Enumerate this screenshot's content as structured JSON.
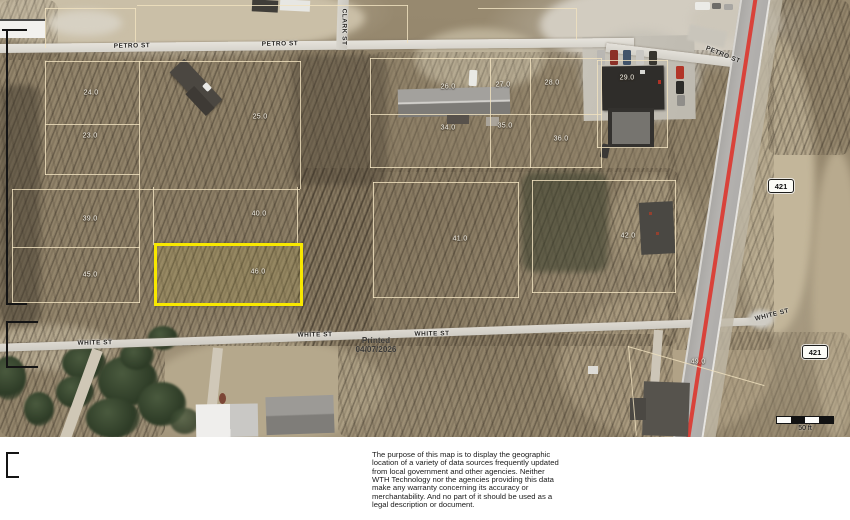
{
  "map": {
    "street_labels": [
      {
        "text": "PETRO ST",
        "x": 132,
        "y": 46,
        "rot": -1
      },
      {
        "text": "PETRO ST",
        "x": 280,
        "y": 44,
        "rot": -1
      },
      {
        "text": "PETRO ST",
        "x": 723,
        "y": 55,
        "rot": 22
      },
      {
        "text": "CLARK ST",
        "x": 344,
        "y": 27,
        "rot": 90
      },
      {
        "text": "WHITE ST",
        "x": 95,
        "y": 343,
        "rot": -1
      },
      {
        "text": "WHITE ST",
        "x": 315,
        "y": 335,
        "rot": -1
      },
      {
        "text": "WHITE ST",
        "x": 432,
        "y": 334,
        "rot": -1
      },
      {
        "text": "WHITE ST",
        "x": 772,
        "y": 315,
        "rot": -14
      }
    ],
    "parcel_labels": [
      {
        "text": "24.0",
        "x": 91,
        "y": 93
      },
      {
        "text": "23.0",
        "x": 90,
        "y": 136
      },
      {
        "text": "25.0",
        "x": 260,
        "y": 117
      },
      {
        "text": "26.0",
        "x": 448,
        "y": 87
      },
      {
        "text": "27.0",
        "x": 503,
        "y": 85
      },
      {
        "text": "28.0",
        "x": 552,
        "y": 83
      },
      {
        "text": "29.0",
        "x": 627,
        "y": 78
      },
      {
        "text": "34.0",
        "x": 448,
        "y": 128
      },
      {
        "text": "35.0",
        "x": 505,
        "y": 126
      },
      {
        "text": "36.0",
        "x": 561,
        "y": 139
      },
      {
        "text": "39.0",
        "x": 90,
        "y": 219
      },
      {
        "text": "40.0",
        "x": 259,
        "y": 214
      },
      {
        "text": "41.0",
        "x": 460,
        "y": 239
      },
      {
        "text": "42.0",
        "x": 628,
        "y": 236
      },
      {
        "text": "45.0",
        "x": 90,
        "y": 275
      },
      {
        "text": "46.0",
        "x": 258,
        "y": 272
      },
      {
        "text": "49.0",
        "x": 698,
        "y": 362
      }
    ],
    "highway_shields": [
      {
        "text": "421",
        "x": 781,
        "y": 186
      },
      {
        "text": "421",
        "x": 815,
        "y": 352
      }
    ],
    "printed": {
      "label": "Printed",
      "date": "04/07/2026"
    },
    "scale_bar": {
      "label": "50 ft"
    },
    "highlight_color": "#f8e800",
    "highway_line_color": "#d9423a"
  },
  "footer": {
    "disclaimer_lines": [
      "The purpose of this map is to display the geographic",
      "location of a variety of data sources frequently updated",
      "from local government and other agencies. Neither",
      "WTH Technology nor the agencies providing this data",
      "make any warranty concerning its accuracy or",
      "merchantability. And no part of it should be used as a",
      "legal description or document."
    ]
  }
}
